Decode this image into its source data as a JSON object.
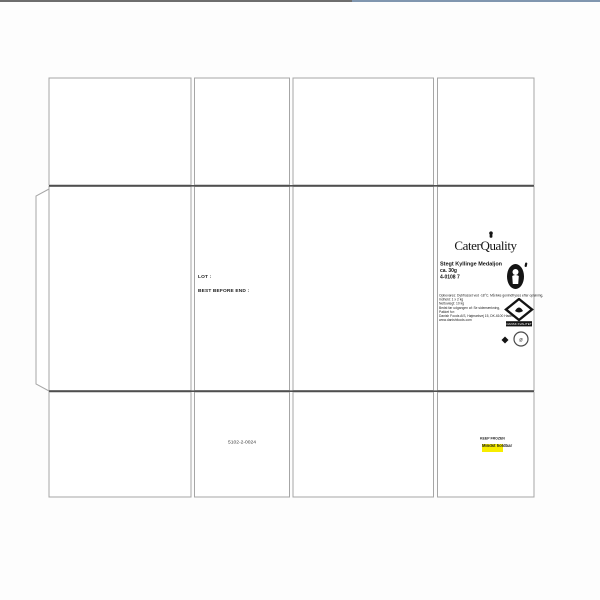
{
  "window": {
    "top_bar_left_color": "#6e6e6e",
    "top_bar_right_color": "#8096af"
  },
  "dieline": {
    "panel_stroke": "#a6a6a6",
    "fold_stroke": "#4f4f4f"
  },
  "lot_panel": {
    "lot_label": "LOT :",
    "best_before_label": "BEST BEFORE END :"
  },
  "codes": {
    "carton_code": "5102-2-0024"
  },
  "label": {
    "brand": "CaterQuality",
    "product_name": "Stegt Kyllinge Medaljon",
    "weight": "ca. 30g",
    "item_no": "4-0108 7",
    "fine_print": [
      "Opbevares: Dybfrosset ved -18°C. Må ikke genindfryses efter optøning,",
      "Indhold: 1 x 2 kg",
      "Nettovægt: 10 kg",
      "Bedst før udgangen af: Se sidemærkning,",
      "Pakket for:",
      "Danish Foods A/S, Højmarkvej 15, DK-6100 Haderslev",
      "www.danishfoods.com"
    ],
    "diamond_badge_text": "DANSK KVALITET",
    "circle_badge_text": "ø"
  },
  "sticker": {
    "line1": "KEEP FROZEN",
    "line2": "Mindst holdbar",
    "highlight_color": "#f7ed00"
  }
}
